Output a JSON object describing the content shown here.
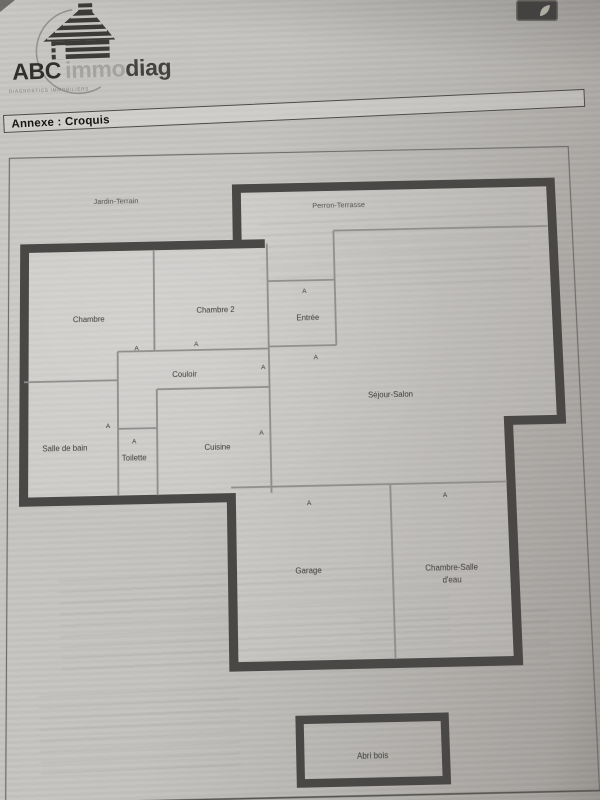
{
  "logo": {
    "brand_part1": "ABC",
    "brand_part2": "immo",
    "brand_part3": "diag",
    "tagline": "DIAGNOSTICS IMMOBILIERS"
  },
  "header": {
    "title": "Annexe : Croquis"
  },
  "plan": {
    "door_marker": "A",
    "areas": {
      "jardin": "Jardin-Terrain",
      "perron": "Perron-Terrasse",
      "chambre": "Chambre",
      "chambre2": "Chambre 2",
      "entree": "Entrée",
      "couloir": "Couloir",
      "sejour": "Séjour-Salon",
      "salle_de_bain": "Salle de bain",
      "toilette": "Toilette",
      "cuisine": "Cuisine",
      "garage": "Garage",
      "chambre_salle_eau_1": "Chambre-Salle",
      "chambre_salle_eau_2": "d'eau",
      "abri_bois": "Abri bois"
    },
    "colors": {
      "wall": "#4a4846",
      "partition": "#8f8d8b",
      "frame": "#6f6d6b",
      "label": "#3b3a38"
    }
  }
}
